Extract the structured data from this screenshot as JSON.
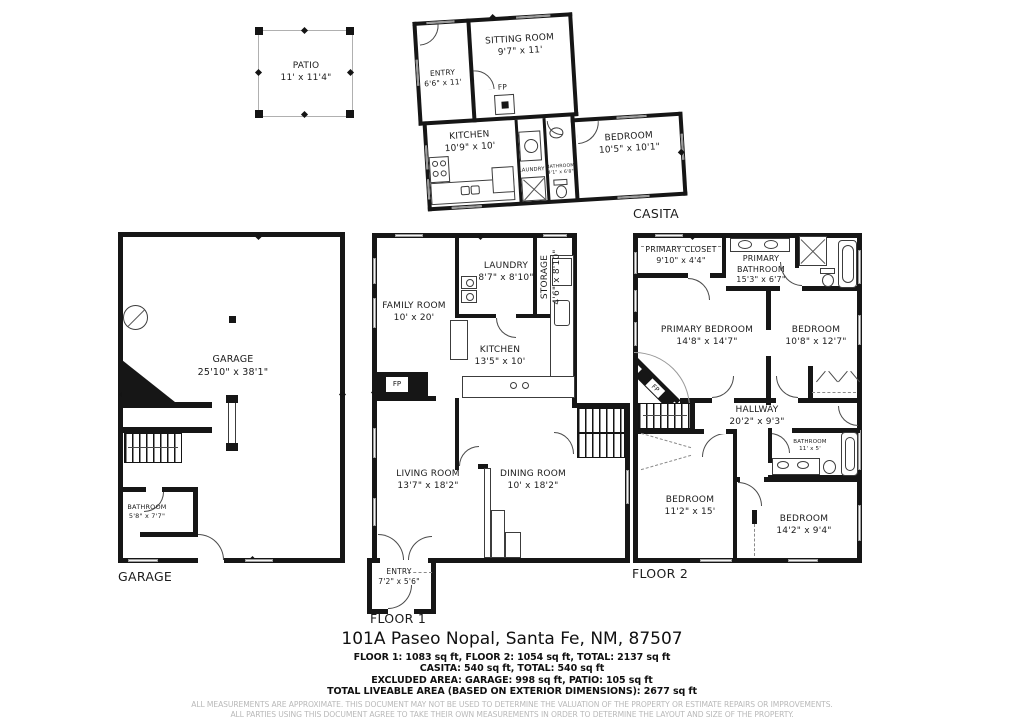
{
  "patio": {
    "name": "PATIO",
    "dims": "11' x 11'4\""
  },
  "casita": {
    "section_label": "CASITA",
    "entry": {
      "name": "ENTRY",
      "dims": "6'6\" x 11'"
    },
    "sitting_room": {
      "name": "SITTING ROOM",
      "dims": "9'7\" x 11'"
    },
    "kitchen": {
      "name": "KITCHEN",
      "dims": "10'9\" x 10'"
    },
    "laundry": {
      "name": "LAUNDRY"
    },
    "bathroom": {
      "name": "BATHROOM",
      "dims": "4'1\" x 6'8\""
    },
    "bedroom": {
      "name": "BEDROOM",
      "dims": "10'5\" x 10'1\""
    },
    "fireplace": "FP"
  },
  "garage": {
    "section_label": "GARAGE",
    "room": {
      "name": "GARAGE",
      "dims": "25'10\" x 38'1\""
    },
    "bathroom": {
      "name": "BATHROOM",
      "dims": "5'8\" x 7'7\""
    }
  },
  "floor1": {
    "section_label": "FLOOR 1",
    "family_room": {
      "name": "FAMILY ROOM",
      "dims": "10' x 20'"
    },
    "laundry": {
      "name": "LAUNDRY",
      "dims": "8'7\" x 8'10\""
    },
    "storage": {
      "name": "STORAGE",
      "dims": "4'6\" x 8'10\""
    },
    "kitchen": {
      "name": "KITCHEN",
      "dims": "13'5\" x 10'"
    },
    "living_room": {
      "name": "LIVING ROOM",
      "dims": "13'7\" x 18'2\""
    },
    "dining_room": {
      "name": "DINING ROOM",
      "dims": "10' x 18'2\""
    },
    "entry": {
      "name": "ENTRY",
      "dims": "7'2\" x 5'6\""
    },
    "fireplace": "FP"
  },
  "floor2": {
    "section_label": "FLOOR 2",
    "primary_closet": {
      "name": "PRIMARY CLOSET",
      "dims": "9'10\" x 4'4\""
    },
    "primary_bathroom": {
      "name": "PRIMARY BATHROOM",
      "dims": "15'3\" x 6'7\""
    },
    "primary_bedroom": {
      "name": "PRIMARY BEDROOM",
      "dims": "14'8\" x 14'7\""
    },
    "bedroom_upper": {
      "name": "BEDROOM",
      "dims": "10'8\" x 12'7\""
    },
    "hallway": {
      "name": "HALLWAY",
      "dims": "20'2\" x 9'3\""
    },
    "bathroom": {
      "name": "BATHROOM",
      "dims": "11' x 5'"
    },
    "bedroom_left": {
      "name": "BEDROOM",
      "dims": "11'2\" x 15'"
    },
    "bedroom_right": {
      "name": "BEDROOM",
      "dims": "14'2\" x 9'4\""
    },
    "fireplace": "FP"
  },
  "footer": {
    "address": "101A Paseo Nopal, Santa Fe, NM, 87507",
    "area_lines": [
      "FLOOR 1: 1083 sq ft, FLOOR 2: 1054 sq ft, TOTAL: 2137 sq ft",
      "CASITA: 540 sq ft, TOTAL: 540 sq ft",
      "EXCLUDED AREA: GARAGE: 998 sq ft, PATIO: 105 sq ft",
      "TOTAL LIVEABLE AREA (BASED ON EXTERIOR DIMENSIONS): 2677 sq ft"
    ],
    "disclaimer": [
      "ALL MEASUREMENTS ARE APPROXIMATE. THIS DOCUMENT MAY NOT BE USED TO DETERMINE THE VALUATION OF THE PROPERTY OR ESTIMATE REPAIRS OR IMPROVEMENTS.",
      "ALL PARTIES USING THIS DOCUMENT AGREE TO TAKE THEIR OWN MEASUREMENTS IN ORDER TO DETERMINE THE LAYOUT AND SIZE OF THE PROPERTY."
    ]
  },
  "colors": {
    "wall": "#161616",
    "window_gray": "#9a9a9a",
    "disclaimer_gray": "#b9b9b9"
  }
}
